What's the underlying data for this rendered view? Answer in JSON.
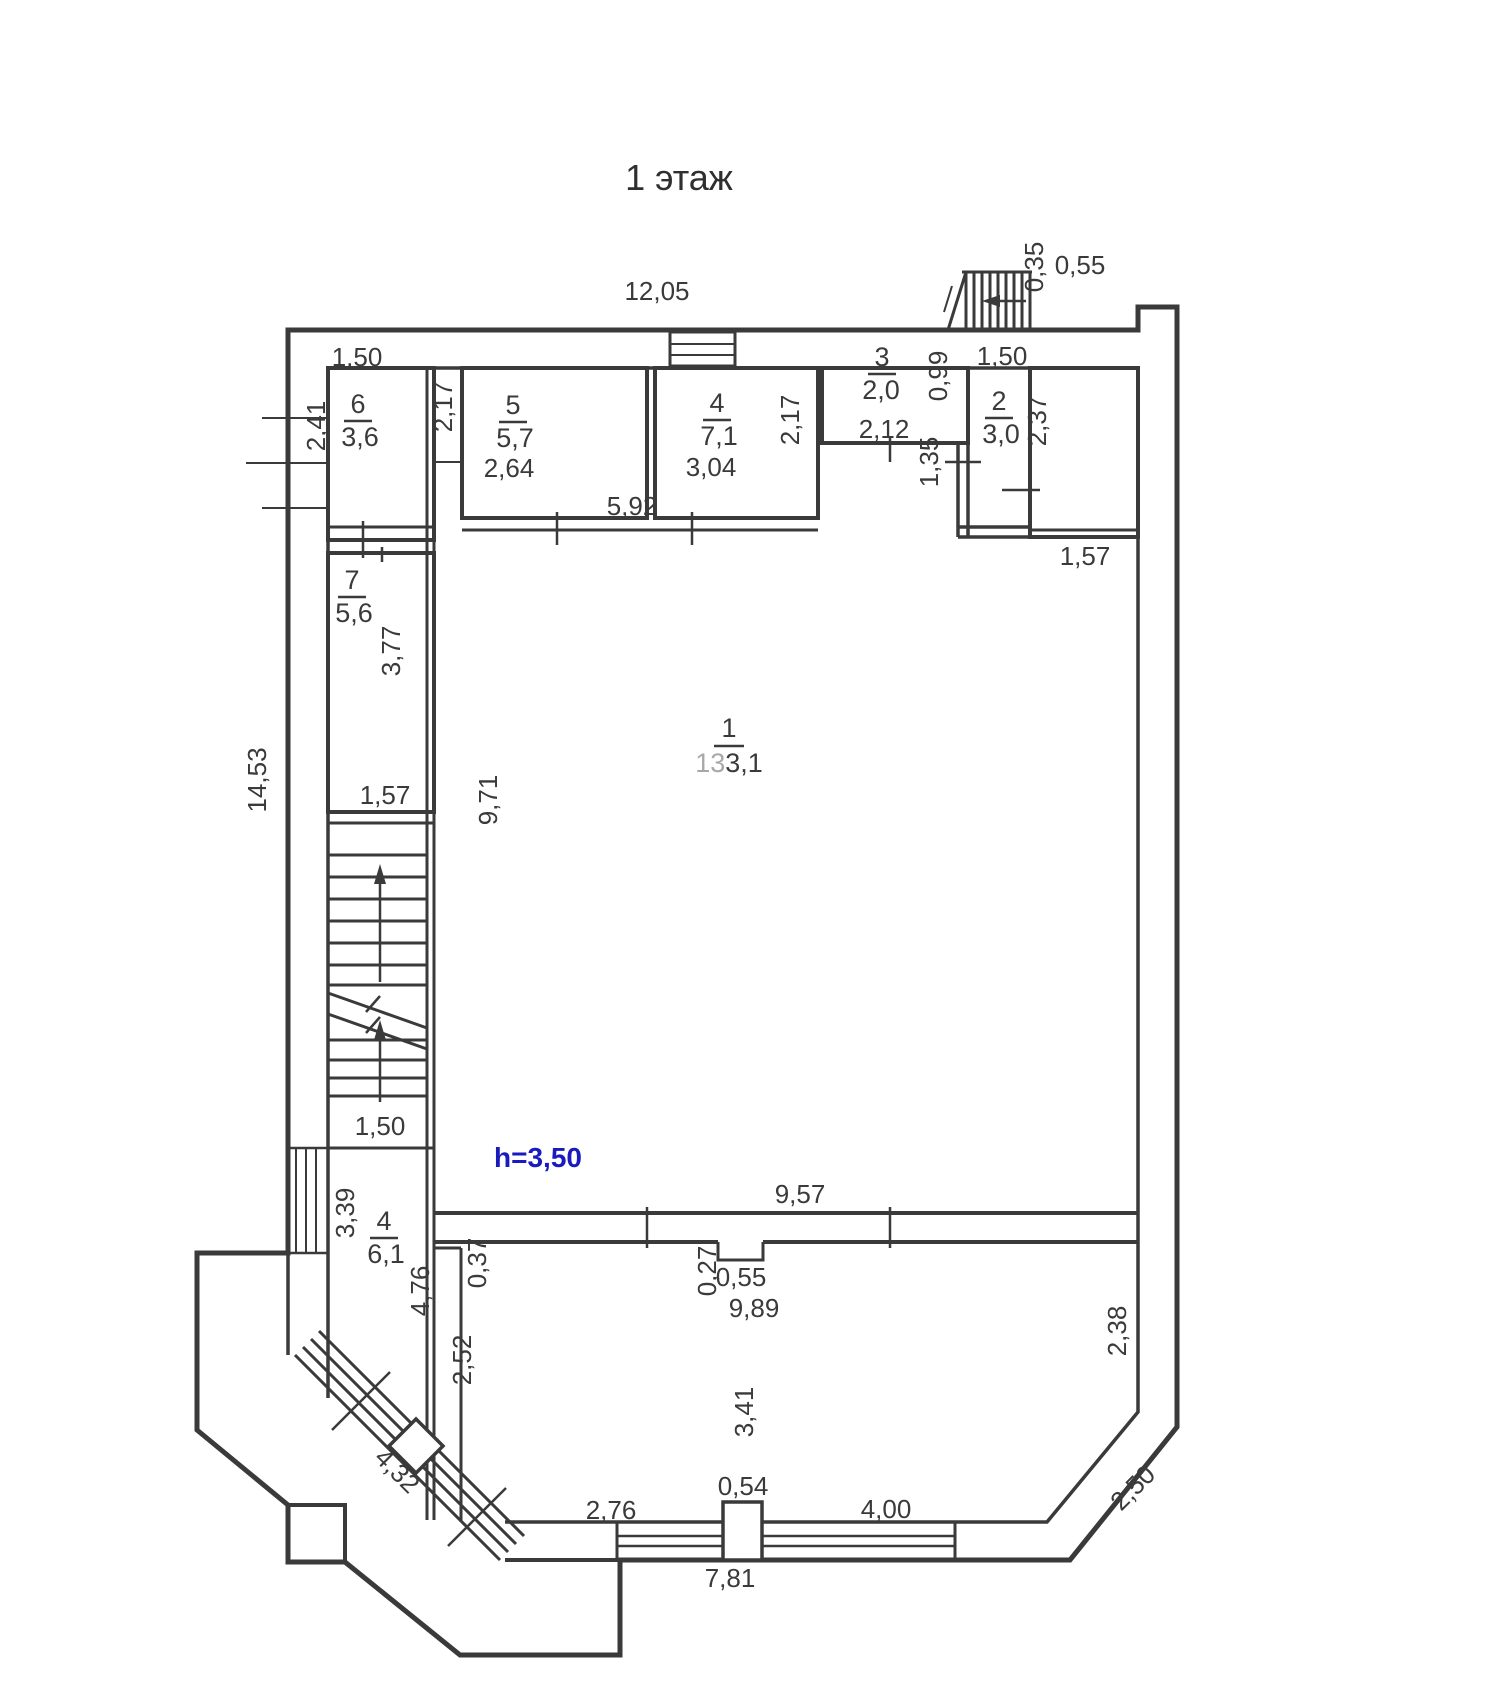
{
  "page": {
    "background": "#ffffff",
    "line_color": "#3a3a3a",
    "text_color": "#3a3a3a",
    "height_note_color": "#1a1abe"
  },
  "floor_plan": {
    "title": "1 этаж",
    "height_note": "h=3,50",
    "rooms": [
      {
        "number": "1",
        "area": "133,1",
        "area_prefix": "13",
        "area_suffix": "3,1"
      },
      {
        "number": "2",
        "area": "3,0"
      },
      {
        "number": "3",
        "area": "2,0"
      },
      {
        "number": "4",
        "area": "7,1"
      },
      {
        "number": "5",
        "area": "5,7"
      },
      {
        "number": "6",
        "area": "3,6"
      },
      {
        "number": "7",
        "area": "5,6"
      },
      {
        "number": "4",
        "area": "6,1"
      }
    ],
    "dimensions": [
      {
        "label": "12,05"
      },
      {
        "label": "0,35"
      },
      {
        "label": "0,55"
      },
      {
        "label": "1,50"
      },
      {
        "label": "2,41"
      },
      {
        "label": "2,17"
      },
      {
        "label": "2,64"
      },
      {
        "label": "5,92"
      },
      {
        "label": "3,04"
      },
      {
        "label": "2,17"
      },
      {
        "label": "2,12"
      },
      {
        "label": "0,99"
      },
      {
        "label": "1,35"
      },
      {
        "label": "1,50"
      },
      {
        "label": "2,37"
      },
      {
        "label": "1,57"
      },
      {
        "label": "3,77"
      },
      {
        "label": "1,57"
      },
      {
        "label": "14,53"
      },
      {
        "label": "9,71"
      },
      {
        "label": "1,50"
      },
      {
        "label": "3,39"
      },
      {
        "label": "4,76"
      },
      {
        "label": "0,37"
      },
      {
        "label": "2,52"
      },
      {
        "label": "9,57"
      },
      {
        "label": "0,27"
      },
      {
        "label": "0,55"
      },
      {
        "label": "9,89"
      },
      {
        "label": "3,41"
      },
      {
        "label": "2,38"
      },
      {
        "label": "2,50"
      },
      {
        "label": "4,32"
      },
      {
        "label": "2,76"
      },
      {
        "label": "0,54"
      },
      {
        "label": "4,00"
      },
      {
        "label": "7,81"
      }
    ]
  }
}
